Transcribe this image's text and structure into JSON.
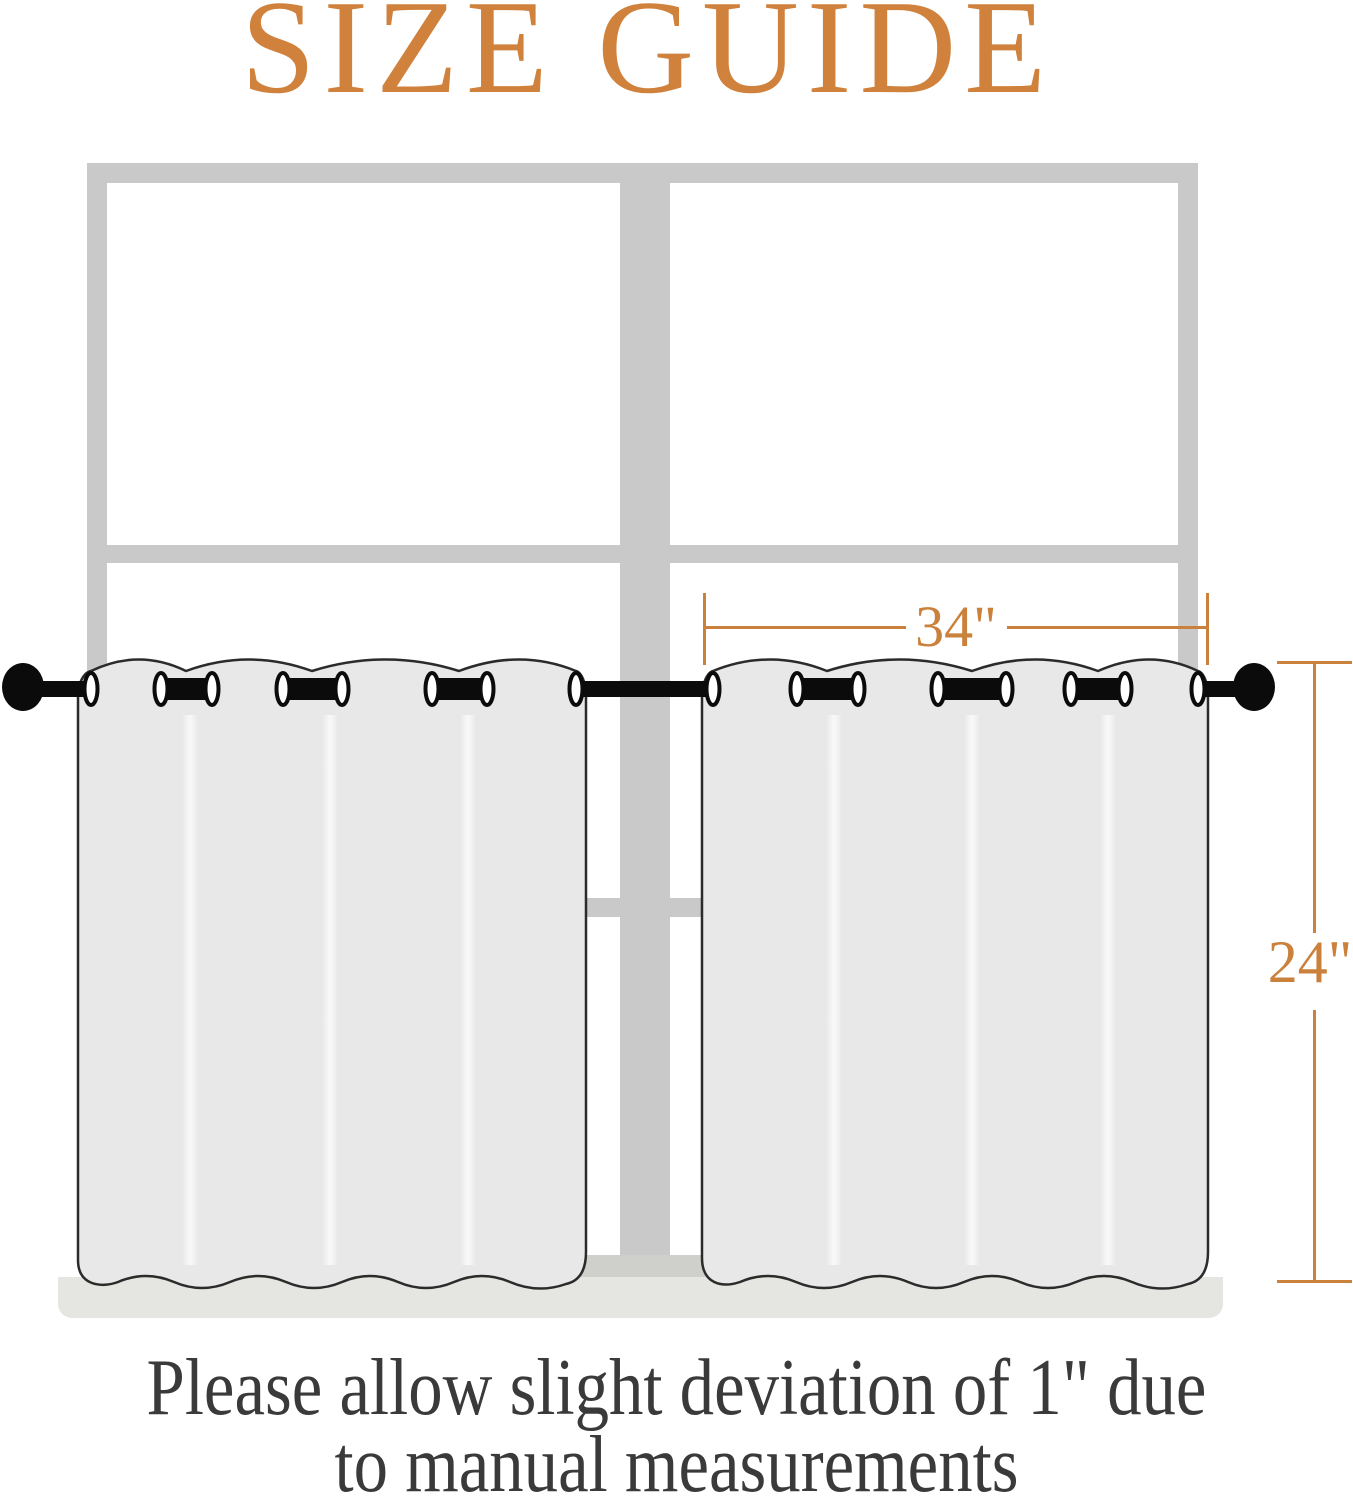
{
  "title": {
    "text": "SIZE GUIDE",
    "color": "#d0823d"
  },
  "dimensions": {
    "color": "#c9813c",
    "width": {
      "label": "34\"",
      "measures": "curtain panel width"
    },
    "height": {
      "label": "24\"",
      "measures": "curtain panel length"
    }
  },
  "note": {
    "line1": "Please allow slight deviation of 1\" due",
    "line2": "to manual measurements",
    "color": "#3a3a3a"
  },
  "scene": {
    "window_frame_color": "#c9c9c9",
    "window_bottom_rail_color": "#cfcfcc",
    "sill_color": "#e5e5e1",
    "curtain_fill": "#e8e8e8",
    "curtain_outline": "#2b2b2b",
    "rod_color": "#0b0b0b",
    "grommet_ring_color": "#ffffff",
    "panel_count": 2,
    "grommet_pairs_per_panel": 3
  }
}
